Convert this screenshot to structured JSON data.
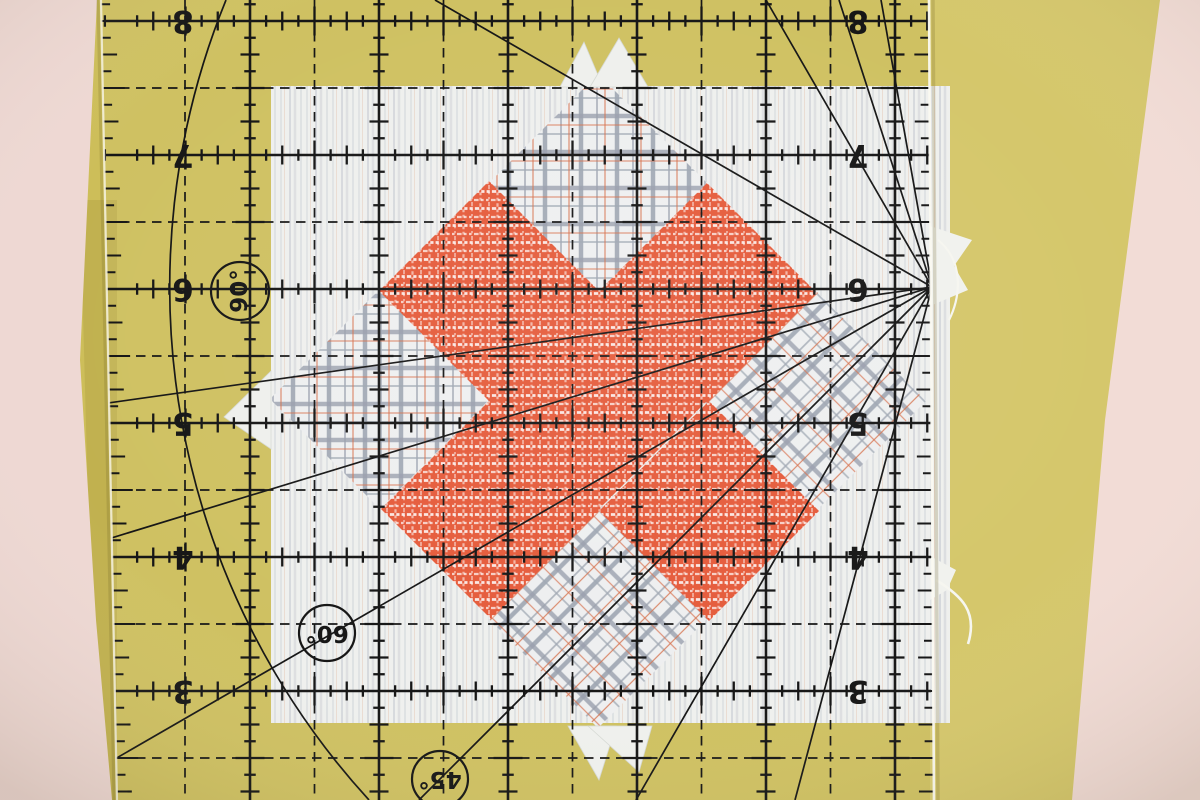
{
  "ruler": {
    "row_labels": [
      "8",
      "7",
      "6",
      "5",
      "4",
      "3"
    ],
    "angle_labels": {
      "a90": "90°",
      "a60": "60°",
      "a45": "45°"
    },
    "ink_color": "#161616"
  },
  "fabrics": {
    "background_yellow": "#cdbe59",
    "border_pink_left": "#eed8d3",
    "border_pink_right": "#f2dcd6",
    "block_white": "#eff0ed",
    "cross_orange": "#e4512f",
    "plaid_grey": "#939aa8",
    "plaid_accent_orange": "#d4663f"
  }
}
